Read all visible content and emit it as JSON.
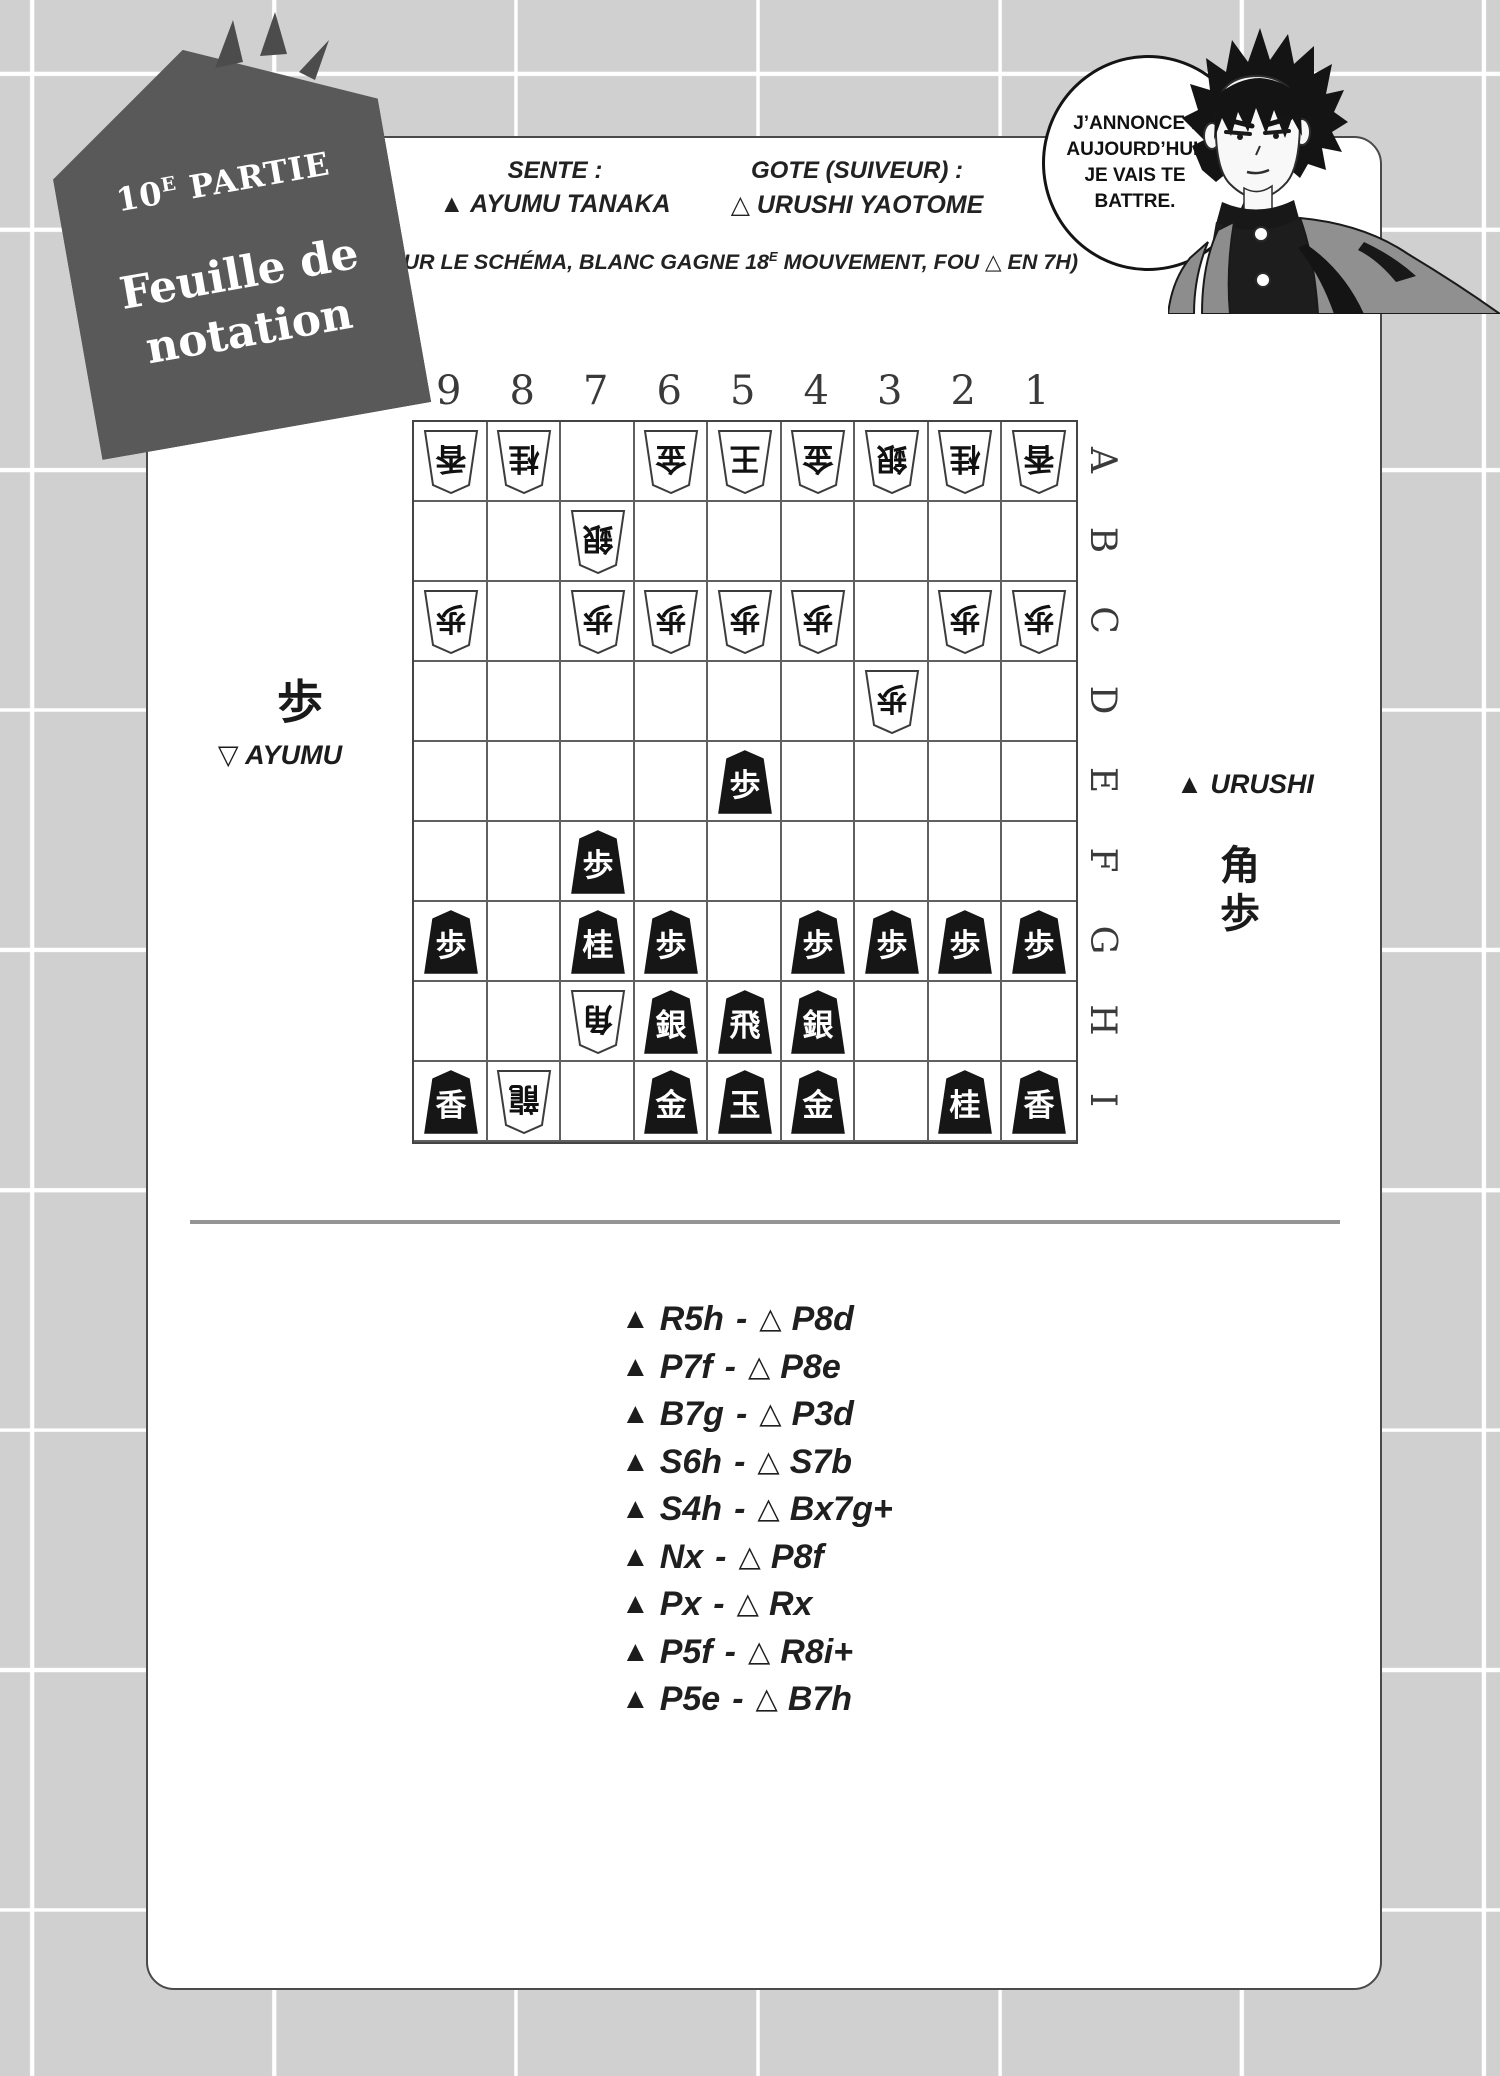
{
  "colors": {
    "background": "#d0d0d0",
    "panel": "#ffffff",
    "tag": "#595959",
    "board_line": "#606060",
    "piece_black": "#161616",
    "divider": "#949494",
    "ink": "#1f1f1f"
  },
  "tag": {
    "part_number": "10",
    "part_sup": "E",
    "part_word": "PARTIE",
    "title_line1": "Feuille de",
    "title_line2": "notation"
  },
  "header": {
    "sente_label": "SENTE :",
    "sente_name": "▲ AYUMU TANAKA",
    "gote_label": "GOTE (SUIVEUR) :",
    "gote_name": "△ URUSHI YAOTOME",
    "note_pre": "(SUR LE SCHÉMA, BLANC GAGNE 18",
    "note_sup": "E",
    "note_post": " MOUVEMENT, FOU △ EN 7H)"
  },
  "speech_bubble": {
    "lines": [
      "J’ANNONCE :",
      "AUJOURD’HUI,",
      "JE VAIS TE",
      "BATTRE."
    ]
  },
  "board": {
    "column_labels": [
      "9",
      "8",
      "7",
      "6",
      "5",
      "4",
      "3",
      "2",
      "1"
    ],
    "row_labels": [
      "A",
      "B",
      "C",
      "D",
      "E",
      "F",
      "G",
      "H",
      "I"
    ],
    "pieces": [
      {
        "col": 9,
        "row": "A",
        "side": "gote",
        "kanji": "香"
      },
      {
        "col": 8,
        "row": "A",
        "side": "gote",
        "kanji": "桂"
      },
      {
        "col": 6,
        "row": "A",
        "side": "gote",
        "kanji": "金"
      },
      {
        "col": 5,
        "row": "A",
        "side": "gote",
        "kanji": "王"
      },
      {
        "col": 4,
        "row": "A",
        "side": "gote",
        "kanji": "金"
      },
      {
        "col": 3,
        "row": "A",
        "side": "gote",
        "kanji": "銀"
      },
      {
        "col": 2,
        "row": "A",
        "side": "gote",
        "kanji": "桂"
      },
      {
        "col": 1,
        "row": "A",
        "side": "gote",
        "kanji": "香"
      },
      {
        "col": 7,
        "row": "B",
        "side": "gote",
        "kanji": "銀"
      },
      {
        "col": 9,
        "row": "C",
        "side": "gote",
        "kanji": "歩"
      },
      {
        "col": 7,
        "row": "C",
        "side": "gote",
        "kanji": "歩"
      },
      {
        "col": 6,
        "row": "C",
        "side": "gote",
        "kanji": "歩"
      },
      {
        "col": 5,
        "row": "C",
        "side": "gote",
        "kanji": "歩"
      },
      {
        "col": 4,
        "row": "C",
        "side": "gote",
        "kanji": "歩"
      },
      {
        "col": 2,
        "row": "C",
        "side": "gote",
        "kanji": "歩"
      },
      {
        "col": 1,
        "row": "C",
        "side": "gote",
        "kanji": "歩"
      },
      {
        "col": 3,
        "row": "D",
        "side": "gote",
        "kanji": "歩"
      },
      {
        "col": 5,
        "row": "E",
        "side": "sente",
        "kanji": "歩"
      },
      {
        "col": 7,
        "row": "F",
        "side": "sente",
        "kanji": "歩"
      },
      {
        "col": 9,
        "row": "G",
        "side": "sente",
        "kanji": "歩"
      },
      {
        "col": 7,
        "row": "G",
        "side": "sente",
        "kanji": "桂"
      },
      {
        "col": 6,
        "row": "G",
        "side": "sente",
        "kanji": "歩"
      },
      {
        "col": 4,
        "row": "G",
        "side": "sente",
        "kanji": "歩"
      },
      {
        "col": 3,
        "row": "G",
        "side": "sente",
        "kanji": "歩"
      },
      {
        "col": 2,
        "row": "G",
        "side": "sente",
        "kanji": "歩"
      },
      {
        "col": 1,
        "row": "G",
        "side": "sente",
        "kanji": "歩"
      },
      {
        "col": 7,
        "row": "H",
        "side": "gote",
        "kanji": "角"
      },
      {
        "col": 6,
        "row": "H",
        "side": "sente",
        "kanji": "銀"
      },
      {
        "col": 5,
        "row": "H",
        "side": "sente",
        "kanji": "飛"
      },
      {
        "col": 4,
        "row": "H",
        "side": "sente",
        "kanji": "銀"
      },
      {
        "col": 9,
        "row": "I",
        "side": "sente",
        "kanji": "香"
      },
      {
        "col": 8,
        "row": "I",
        "side": "gote",
        "kanji": "龍"
      },
      {
        "col": 6,
        "row": "I",
        "side": "sente",
        "kanji": "金"
      },
      {
        "col": 5,
        "row": "I",
        "side": "sente",
        "kanji": "玉"
      },
      {
        "col": 4,
        "row": "I",
        "side": "sente",
        "kanji": "金"
      },
      {
        "col": 2,
        "row": "I",
        "side": "sente",
        "kanji": "桂"
      },
      {
        "col": 1,
        "row": "I",
        "side": "sente",
        "kanji": "香"
      }
    ]
  },
  "hands": {
    "left": {
      "pieces": [
        "歩"
      ],
      "player": "▽ AYUMU"
    },
    "right": {
      "player": "▲ URUSHI",
      "pieces": [
        "角",
        "歩"
      ]
    }
  },
  "moves": {
    "sente_mark": "▲",
    "gote_mark": "△",
    "separator": "-",
    "list": [
      {
        "sente": "R5h",
        "gote": "P8d"
      },
      {
        "sente": "P7f",
        "gote": "P8e"
      },
      {
        "sente": "B7g",
        "gote": "P3d"
      },
      {
        "sente": "S6h",
        "gote": "S7b"
      },
      {
        "sente": "S4h",
        "gote": "Bx7g+"
      },
      {
        "sente": "Nx",
        "gote": "P8f"
      },
      {
        "sente": "Px",
        "gote": "Rx"
      },
      {
        "sente": "P5f",
        "gote": "R8i+"
      },
      {
        "sente": "P5e",
        "gote": "B7h"
      }
    ]
  }
}
